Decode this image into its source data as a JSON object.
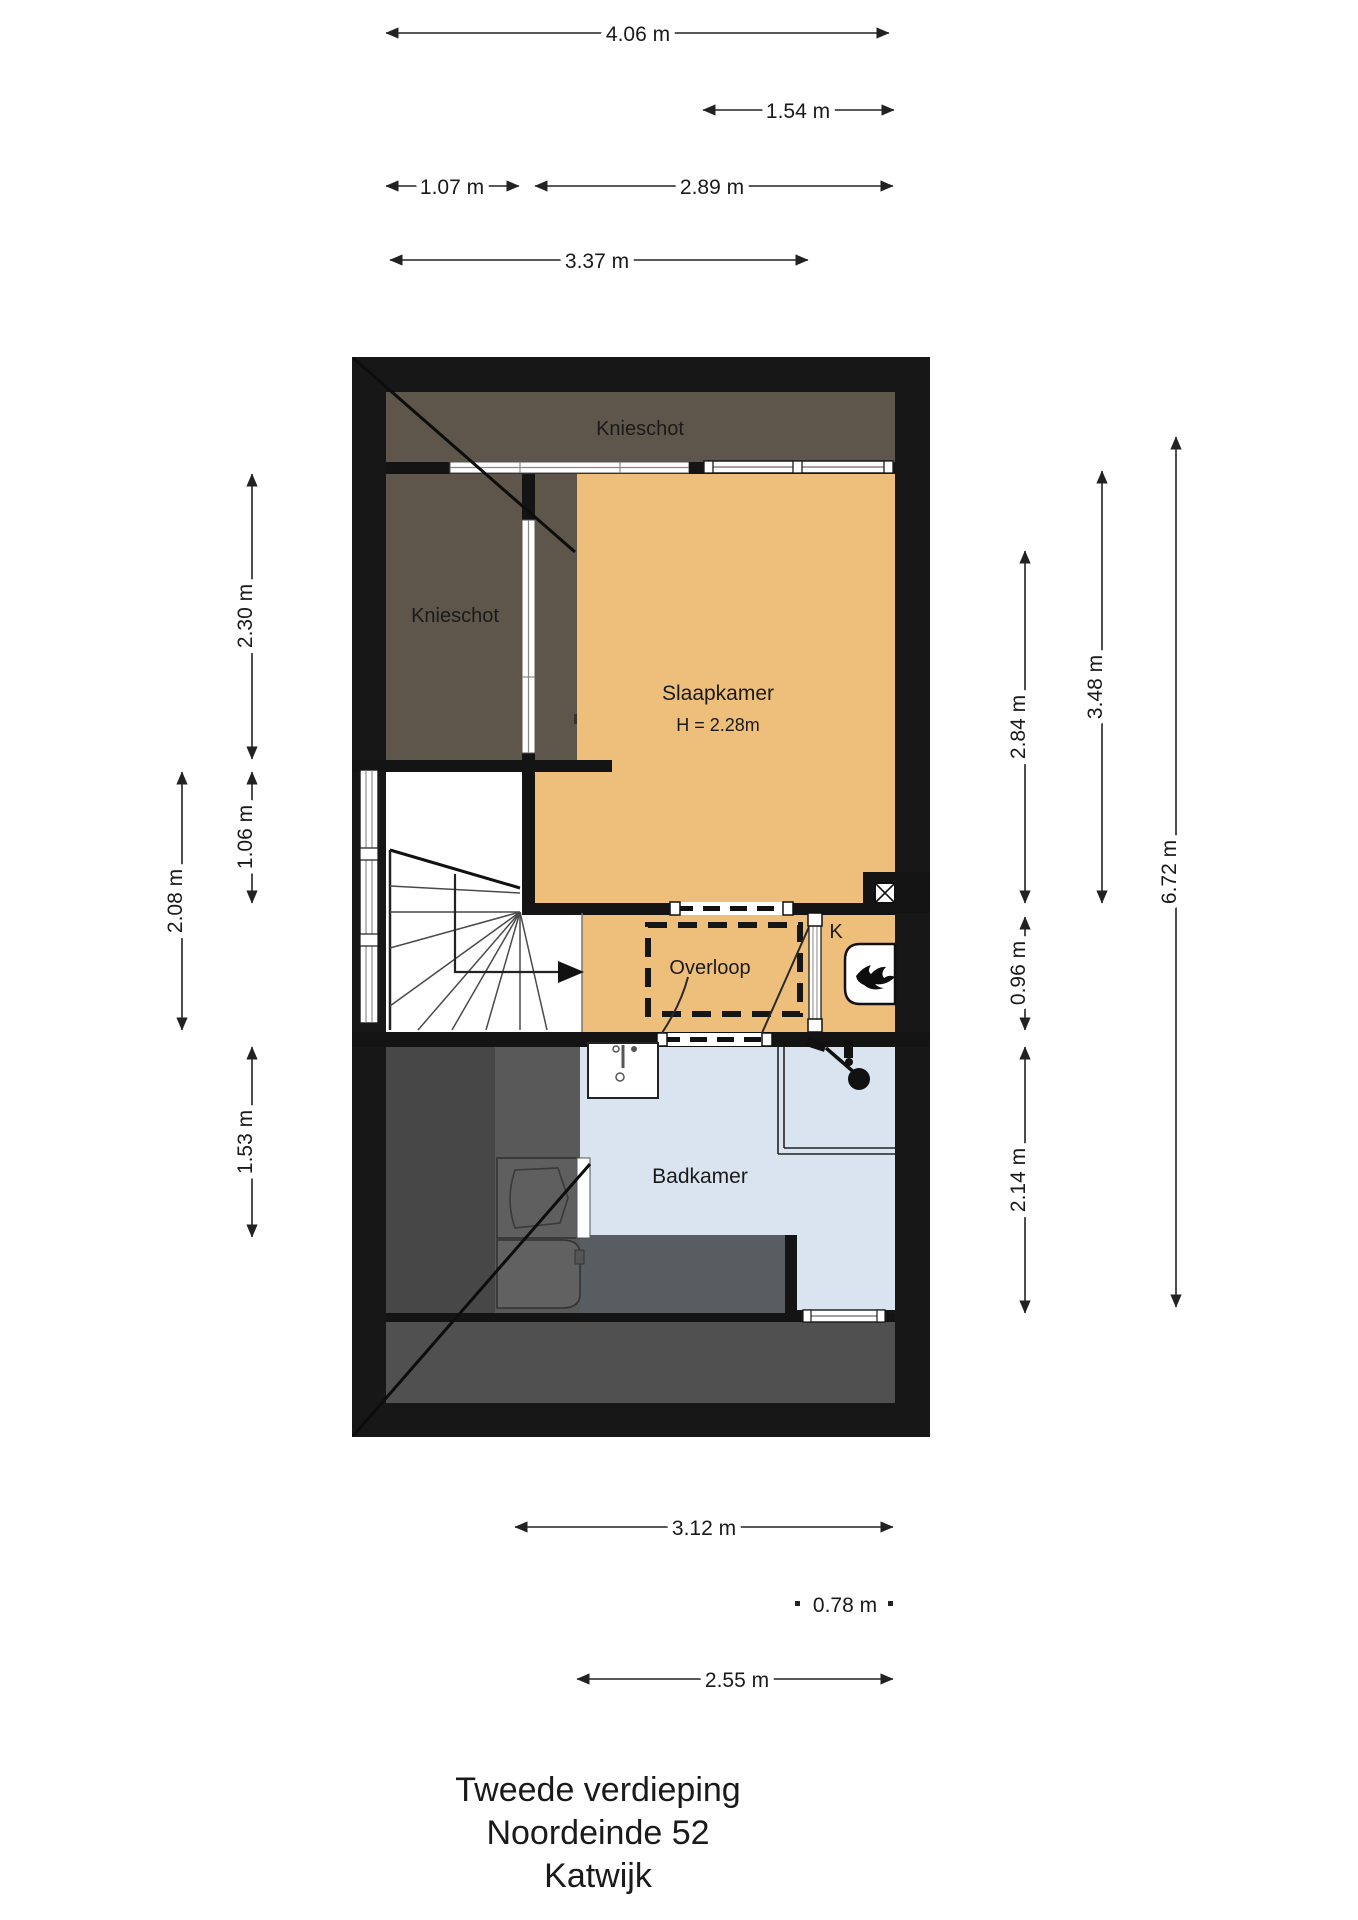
{
  "document": {
    "type": "floorplan",
    "floor_label": "Tweede verdieping",
    "address_line": "Noordeinde 52",
    "city_line": "Katwijk"
  },
  "rooms": {
    "knieschot_top": "Knieschot",
    "knieschot_left": "Knieschot",
    "slaapkamer": "Slaapkamer",
    "slaapkamer_height": "H = 2.28m",
    "overloop": "Overloop",
    "kast": "K",
    "badkamer": "Badkamer"
  },
  "dims": {
    "top_total_width": "4.06 m",
    "top_window_width": "1.54 m",
    "top_left_segment": "1.07 m",
    "top_right_segment": "2.89 m",
    "top_inner_width": "3.37 m",
    "left_knieschot_depth": "2.30 m",
    "left_stair_upper": "1.06 m",
    "left_stairwell": "2.08 m",
    "left_badkamer": "1.53 m",
    "right_slaapkamer": "2.84 m",
    "right_kast": "0.96 m",
    "right_badkamer": "2.14 m",
    "right_slaapkamer_total": "3.48 m",
    "right_total_depth": "6.72 m",
    "bottom_badkamer_total": "3.12 m",
    "bottom_right_segment": "0.78 m",
    "bottom_inner_width": "2.55 m"
  },
  "colors": {
    "wall": "#171717",
    "knieschot_brown": "#5e564a",
    "room_orange": "#eebf7b",
    "bathroom_blue": "#d9e4f0",
    "gray_dark": "#474747",
    "gray_mid": "#595959",
    "gray_low": "#505050",
    "gray_blue": "#585d62",
    "line_dark": "#1a1a1a"
  }
}
